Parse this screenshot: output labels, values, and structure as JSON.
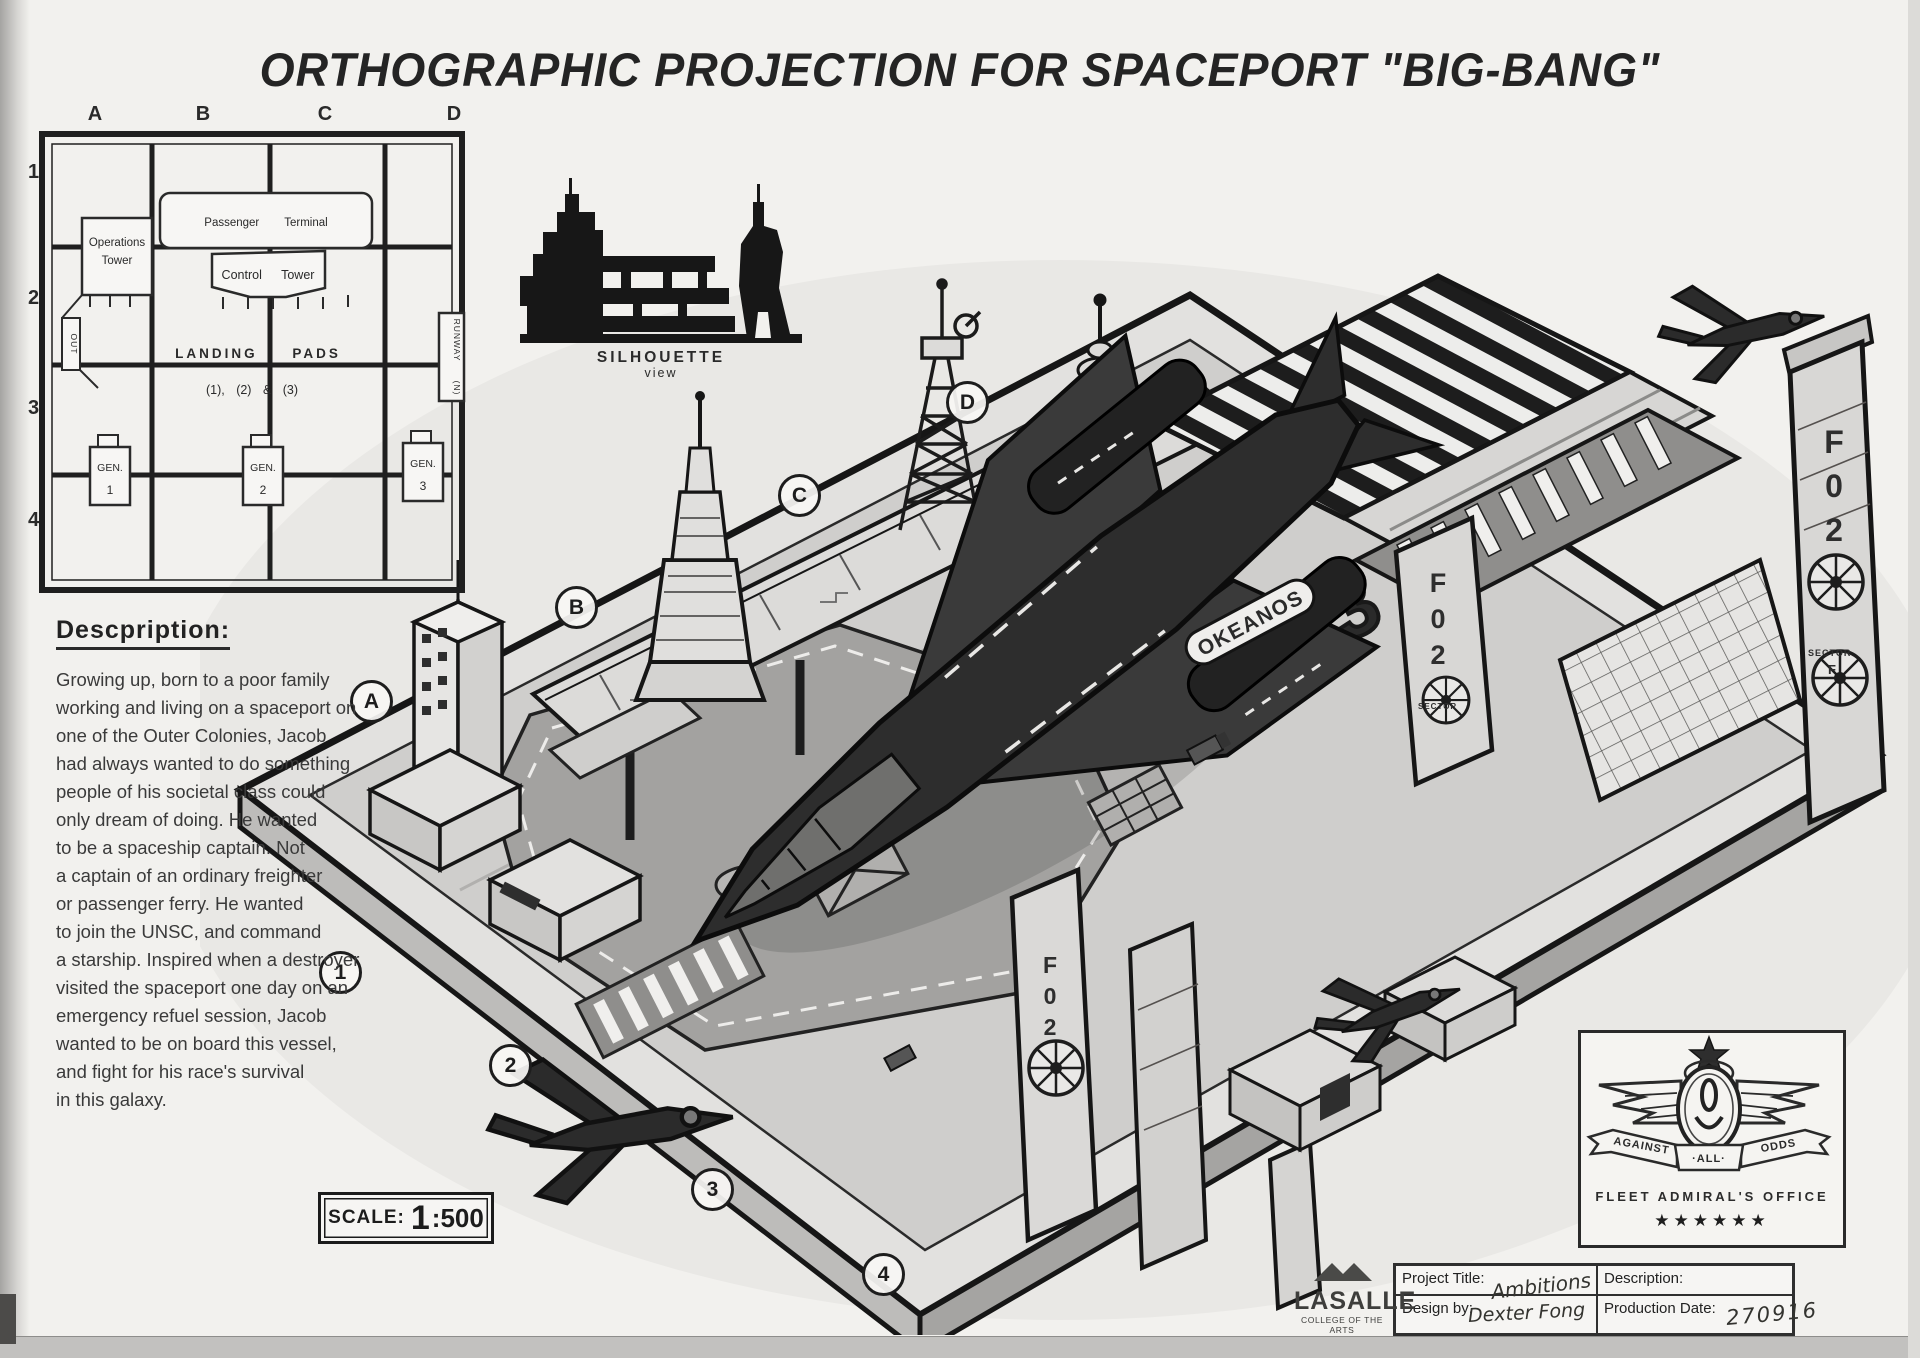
{
  "title": "ORTHOGRAPHIC PROJECTION FOR SPACEPORT \"BIG-BANG\"",
  "plan": {
    "columns": [
      "A",
      "B",
      "C",
      "D"
    ],
    "rows": [
      "1",
      "2",
      "3",
      "4"
    ],
    "operations_tower_1": "Operations",
    "operations_tower_2": "Tower",
    "passenger_terminal": "Passenger  Terminal",
    "control_tower": "Control  Tower",
    "landing_pads_1": "LANDING  PADS",
    "landing_pads_2": "(1), (2)  &  (3)",
    "runway": "RUNWAY",
    "runway_dir": "(N)",
    "out_label": "OUT",
    "gen_label": "GEN.",
    "gen_numbers": [
      "1",
      "2",
      "3"
    ]
  },
  "silhouette": {
    "caption_1": "SILHOUETTE",
    "caption_2": "view"
  },
  "description": {
    "heading": "Descpription:",
    "lines": [
      "Growing up, born to a poor family",
      "working and living on a spaceport on",
      "one of the Outer Colonies, Jacob",
      "had always wanted to do something",
      "people of his societal class could",
      "only dream of doing. He wanted",
      "to be a spaceship captain. Not",
      "a captain of an ordinary freighter",
      "or passenger ferry. He wanted",
      "to join the UNSC, and command",
      "a starship. Inspired when a destroyer",
      "visited the spaceport one day on an",
      "emergency refuel session, Jacob",
      "wanted to be on board this vessel,",
      "and fight for his race's survival",
      "in this galaxy."
    ]
  },
  "scale_box": {
    "label": "SCALE:",
    "big_digit": "1",
    "ratio": ":500"
  },
  "drawing": {
    "markers_letters": [
      "A",
      "B",
      "C",
      "D"
    ],
    "markers_numbers": [
      "1",
      "2",
      "3",
      "4"
    ],
    "ship_name": "OKEANOS",
    "pad_marking": "F-03",
    "tower_marking": "F02",
    "sector_label": "SECTOR",
    "sector_letter": "F"
  },
  "badge": {
    "motto_left": "AGAINST",
    "motto_center": "·ALL·",
    "motto_right": "ODDS",
    "office_title": "FLEET ADMIRAL'S OFFICE",
    "stars": "★★★★★★"
  },
  "title_block": {
    "project_title_label": "Project Title:",
    "project_title_value": "Ambitions",
    "description_label": "Description:",
    "description_value": "",
    "design_by_label": "Design by:",
    "design_by_value": "Dexter Fong",
    "production_date_label": "Production Date:",
    "production_date_value": "270916"
  },
  "logo": {
    "brand": "LASALLE",
    "subtitle": "COLLEGE OF THE ARTS"
  }
}
